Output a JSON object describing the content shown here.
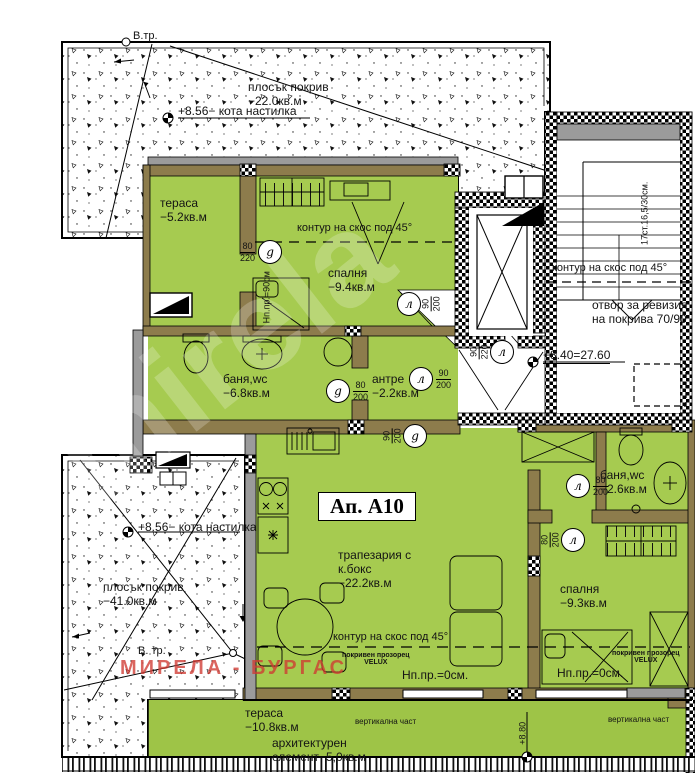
{
  "apartment": {
    "label": "Ап. А10"
  },
  "rooms": {
    "terrace_top": {
      "name": "тераса",
      "area": "−5.2кв.м"
    },
    "bedroom_top": {
      "name": "спалня",
      "area": "−9.4кв.м"
    },
    "bath_main": {
      "name": "баня,wc",
      "area": "−6.8кв.м"
    },
    "hall": {
      "name": "антре",
      "area": "−2.2кв.м"
    },
    "living": {
      "line1": "трапезария с",
      "line2": "к.бокс",
      "area": "−22.2кв.м"
    },
    "bath_small": {
      "name": "баня,wc",
      "area": "−2.6кв.м"
    },
    "bedroom_right": {
      "name": "спалня",
      "area": "−9.3кв.м"
    },
    "terrace_bottom": {
      "name": "тераса",
      "area": "−10.8кв.м"
    }
  },
  "roofs": {
    "top": {
      "name": "плосък покрив",
      "area": "−22.0кв.м"
    },
    "bottom": {
      "name": "плосък покрив",
      "area": "−41.0кв.м"
    }
  },
  "levels": {
    "roof_top": "+8.56− кота настилка",
    "roof_bottom": "+8.56− кота настилка",
    "landing": "+8.40=27.60",
    "terrace": "+8.80"
  },
  "doors": [
    {
      "letter": "g",
      "w": "80",
      "h": "220"
    },
    {
      "letter": "л",
      "w": "90",
      "h": "200"
    },
    {
      "letter": "л",
      "w": "90",
      "h": "200"
    },
    {
      "letter": "g",
      "w": "80",
      "h": "200"
    },
    {
      "letter": "g",
      "w": "90",
      "h": "200"
    },
    {
      "letter": "л",
      "w": "90",
      "h": "220"
    },
    {
      "letter": "л",
      "w": "80",
      "h": "200"
    },
    {
      "letter": "л",
      "w": "80",
      "h": "200"
    }
  ],
  "notes": {
    "slope": "контур на скос под 45°",
    "revision": "отвор за ревизия на покрива 70/90",
    "stairs": "17ст.16,5/30см.",
    "velux_l1": "покривен прозорец",
    "velux_l2": "VELUX",
    "sill_zero": "Нп.пр.=0см.",
    "sill_90": "Нп.пр.=90см",
    "vertical_part": "вертикална част",
    "arch_l1": "архитектурен",
    "arch_l2": "елемент−5,0кв.м",
    "vtr": "В.тр.",
    "vtr2": "В. тр.",
    "watermark": "МИРЕЛА - БУРГАС",
    "watermark_diag": "mirela"
  },
  "colors": {
    "room_green": "#a6cb50",
    "wall_tan": "#8d7c4c",
    "wall_gray": "#9b9b9b",
    "watermark_red": "#d03a32"
  }
}
